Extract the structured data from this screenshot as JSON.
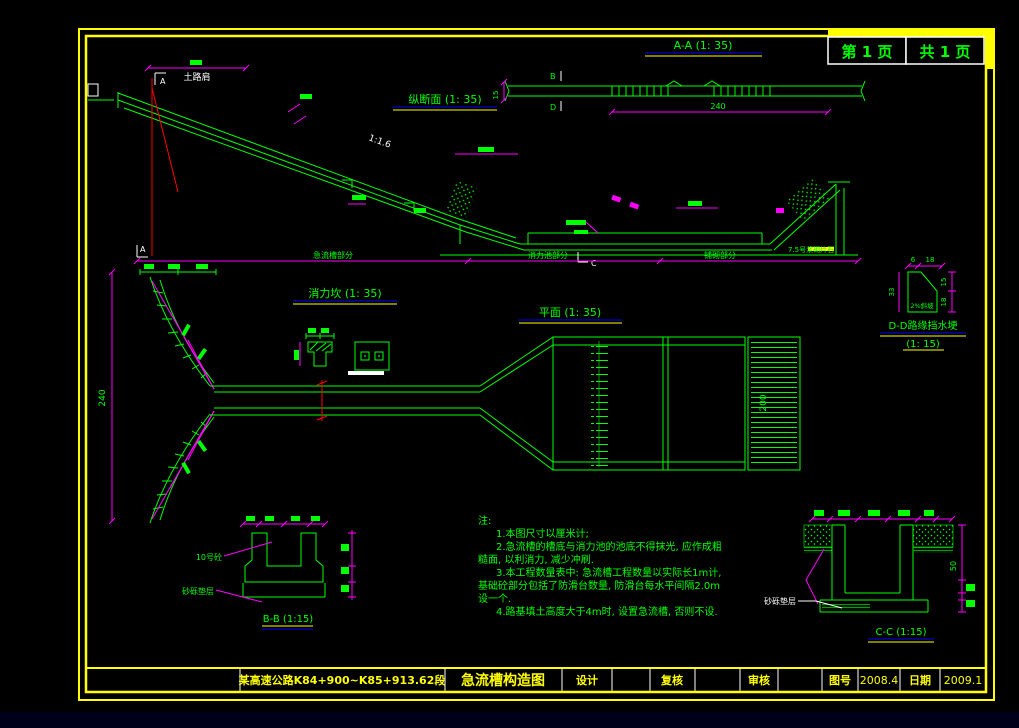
{
  "frame": {
    "page_current": "第 1 页",
    "page_total": "共 1 页"
  },
  "view_titles": {
    "aa": "A-A (1: 35)",
    "profile": "纵断面 (1: 35)",
    "sill": "消力坎 (1: 35)",
    "plan": "平面 (1: 35)",
    "dd": "D-D路缘挡水埂",
    "dd_scale": "(1: 15)",
    "bb": "B-B (1:15)",
    "cc": "C-C (1:15)"
  },
  "annotations": {
    "shoulder": "土路肩",
    "slope": "1:1.6",
    "sec_a_top": "A",
    "sec_a_bottom": "A",
    "sec_b": "B",
    "sec_d": "D",
    "sec_c": "C",
    "chute_part": "急流槽部分",
    "basin_part": "消力池部分",
    "apron_part": "铺砌部分",
    "masonry": "7.5号浆砌片石",
    "dd_slope": "2%斜坡",
    "bb_wall": "10号砼",
    "bb_cushion": "砂砾垫层",
    "cc_cushion": "砂砾垫层"
  },
  "dimensions": {
    "flare_height": "240",
    "plan_depth": "200",
    "aa_length": "240",
    "aa_thickness": "15",
    "dd_top_a": "6",
    "dd_top_b": "18",
    "dd_left": "33",
    "dd_right_a": "15",
    "dd_right_b": "18",
    "cc_depth": "50"
  },
  "notes": {
    "heading": "注:",
    "lines": [
      "1.本图尺寸以厘米计;",
      "2.急流槽的槽底与消力池的池底不得抹光, 应作成粗",
      "糙面, 以利消力, 减少冲刷.",
      "3.本工程数量表中: 急流槽工程数量以实际长1m计,",
      "基础砼部分包括了防滑台数量, 防滑台每水平间隔2.0m",
      "设一个.",
      "4.路基填土高度大于4m时, 设置急流槽, 否则不设."
    ]
  },
  "title_block": {
    "project": "某高速公路K84+900~K85+913.62段",
    "drawing_title": "急流槽构造图",
    "design_label": "设计",
    "recheck_label": "复核",
    "review_label": "审核",
    "figno_label": "图号",
    "figno_value": "2008.4",
    "date_label": "日期",
    "date_value": "2009.1"
  }
}
